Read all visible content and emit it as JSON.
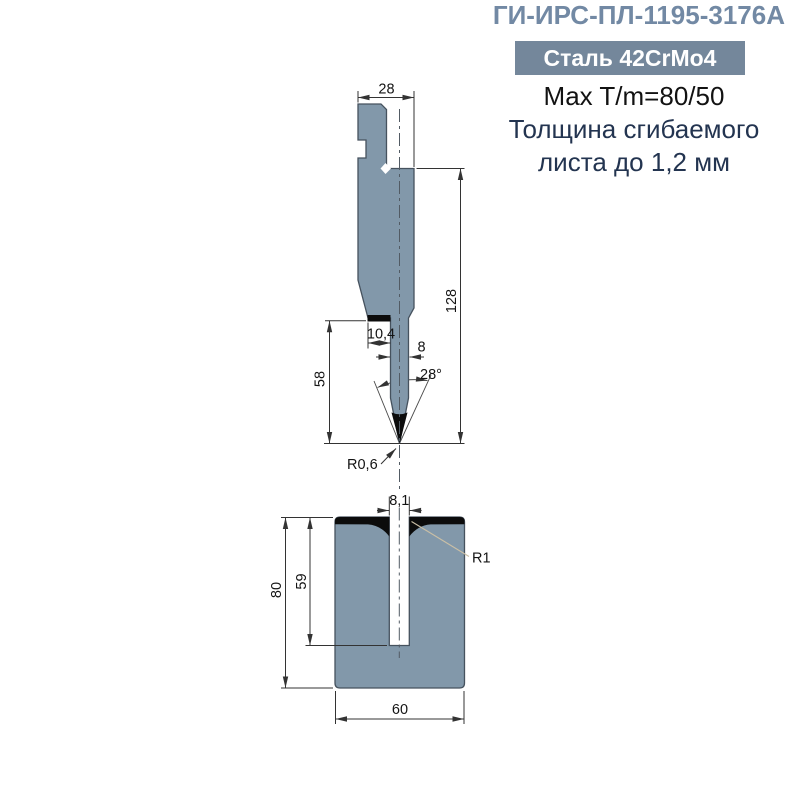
{
  "header": {
    "title": "ГИ-ИРС-ПЛ-1195-3176А",
    "steel_badge": "Сталь 42CrMo4",
    "max_line": "Max T/m=80/50",
    "thickness_line1": "Толщина сгибаемого",
    "thickness_line2": "листа до 1,2 мм"
  },
  "drawing": {
    "punch": {
      "top_width": "28",
      "total_height": "128",
      "shoulder_width": "10,4",
      "blade_width": "8",
      "tip_angle": "28°",
      "working_height": "58",
      "tip_radius": "R0,6"
    },
    "die": {
      "slot_width": "8,1",
      "slot_radius": "R1",
      "slot_depth": "59",
      "height": "80",
      "width": "60"
    }
  },
  "colors": {
    "title_accent": "#7289a4",
    "badge_bg": "#74879b",
    "steel_fill": "#8298aa",
    "outline": "#46525e",
    "hardened_black": "#0c0c0c",
    "navy_text": "#233450",
    "leader_tan": "#cabfa6"
  }
}
